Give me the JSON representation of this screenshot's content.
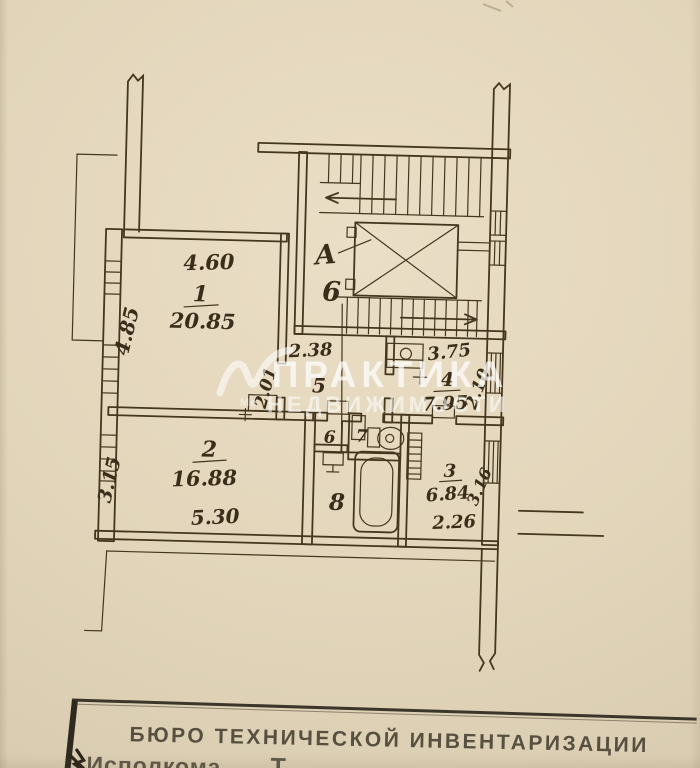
{
  "plan": {
    "rooms": [
      {
        "number": "1",
        "area": "20.85",
        "width": "4.60",
        "height": "4.85"
      },
      {
        "number": "2",
        "area": "16.88",
        "width": "5.30",
        "height": "3.15"
      },
      {
        "number": "3",
        "area": "6.84",
        "width": "2.26",
        "height": "3.16"
      },
      {
        "number": "4",
        "area": "7.95",
        "width": "3.75",
        "height": "2.10"
      },
      {
        "number": "5",
        "width": "2.38",
        "height": "2.01"
      },
      {
        "number": "6"
      },
      {
        "number": "7"
      },
      {
        "number": "8"
      }
    ],
    "stairwell": {
      "letter": "А",
      "number": "6"
    }
  },
  "watermark": {
    "line1": "ПРАКТИКА",
    "line2": "НЕДВИЖИМОСТИ",
    "logo_caption": "Ме"
  },
  "stamp": {
    "line1": "БЮРО ТЕХНИЧЕСКОЙ ИНВЕНТАРИЗАЦИИ",
    "line2": "Исполкома",
    "line2_right": "Т"
  },
  "colors": {
    "paper": "#e2d5ba",
    "ink": "#44361f",
    "watermark": "#ffffff",
    "stamp_ink": "#453e31"
  }
}
